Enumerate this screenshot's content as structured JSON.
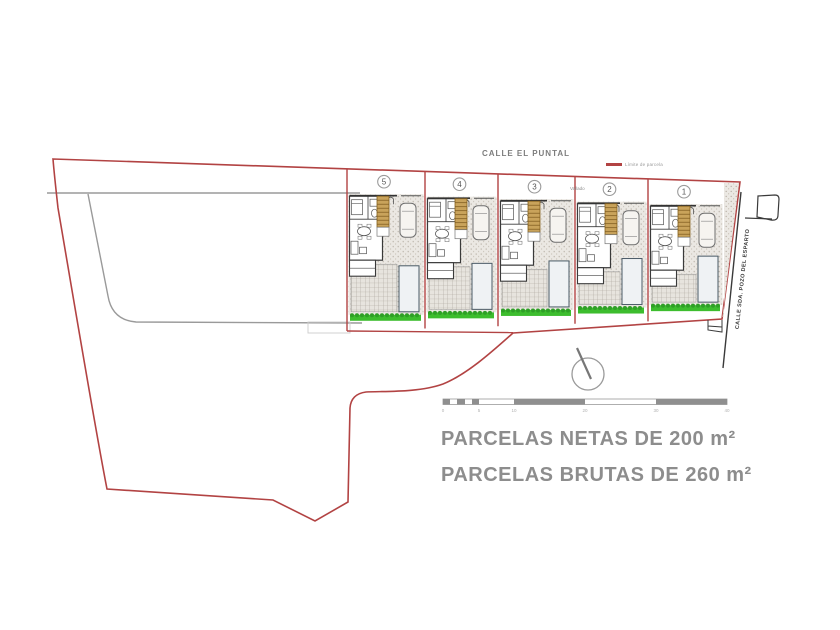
{
  "plan": {
    "top_street": "CALLE EL PUNTAL",
    "side_street": "CALLE SDA. POZO DEL ESPARTO",
    "legend_label": "Límite de parcela",
    "fence_note": "Vallado",
    "plot_numbers": [
      "5",
      "4",
      "3",
      "2",
      "1"
    ],
    "title_line1": "PARCELAS NETAS DE 200 m²",
    "title_line2": "PARCELAS BRUTAS DE 260 m²",
    "scale_ticks": [
      "0",
      "5",
      "10",
      "20",
      "30",
      "40"
    ],
    "colors": {
      "boundary_red": "#b24343",
      "hedge_green": "#3dbd2e",
      "hedge_green_dark": "#2f9f27",
      "stair_tan": "#c9a35b",
      "title_gray": "#8d8d8d",
      "drawing_gray": "#9a9a9a"
    }
  }
}
